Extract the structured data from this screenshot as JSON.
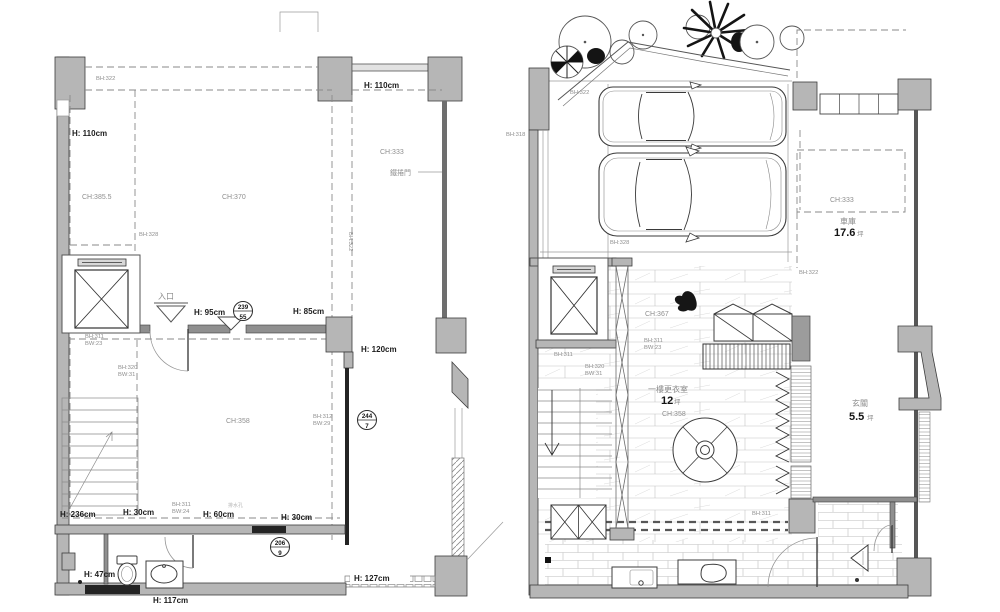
{
  "colors": {
    "wall": "#b6b6b6",
    "wallDark": "#8f8f8f",
    "line": "#3c3c3c",
    "dash": "#8a8a8a",
    "label": "#8f8f8f",
    "labelBold": "#1d1d1d"
  },
  "left_plan": {
    "labels": {
      "bh322_top": "BH:322",
      "h110_left": "H: 110cm",
      "h110_top": "H: 110cm",
      "ch385": "CH:385.5",
      "ch370": "CH:370",
      "ch333": "CH:333",
      "rolling_door": "鐵捲門",
      "bh328": "BH:328",
      "bh322_vert": "BH:322",
      "entrance": "入口",
      "h95": "H: 95cm",
      "h85": "H: 85cm",
      "h120": "H: 120cm",
      "bh311_a": "BH:311",
      "bw23": "BW:23",
      "bh320": "BH:320",
      "bw31": "BW:31",
      "ch358": "CH:358",
      "bh312": "BH:312",
      "bw29": "BW:29",
      "h236": "H: 236cm",
      "h30_a": "H: 30cm",
      "bh311_b": "BH:311",
      "bw24": "BW:24",
      "h60": "H: 60cm",
      "drain_note": "排水孔",
      "h30_b": "H: 30cm",
      "h47": "H: 47cm",
      "h117": "H: 117cm",
      "h127": "H: 127cm"
    },
    "markers": {
      "m1": {
        "top": "239",
        "bottom": "55"
      },
      "m2": {
        "top": "244",
        "bottom": "7"
      },
      "m3": {
        "top": "206",
        "bottom": "9"
      }
    }
  },
  "right_plan": {
    "labels": {
      "bh318": "BH:318",
      "bh322_drive": "BH:322",
      "bh328": "BH:328",
      "bh322_right": "BH:322",
      "bh311_elevator": "BH:311",
      "bh320": "BH:320",
      "bw31": "BW:31",
      "ch367": "CH:367",
      "bh311_beam": "BH:311",
      "bw23": "BW:23",
      "bh311_floor": "BH:311"
    },
    "rooms": {
      "garage": {
        "ch": "CH:333",
        "name": "車庫",
        "area": "17.6",
        "unit": "坪"
      },
      "dressing": {
        "name": "一樓更衣室",
        "area": "12",
        "unit": "坪",
        "ch": "CH:358"
      },
      "foyer": {
        "name": "玄關",
        "area": "5.5",
        "unit": "坪"
      }
    }
  }
}
